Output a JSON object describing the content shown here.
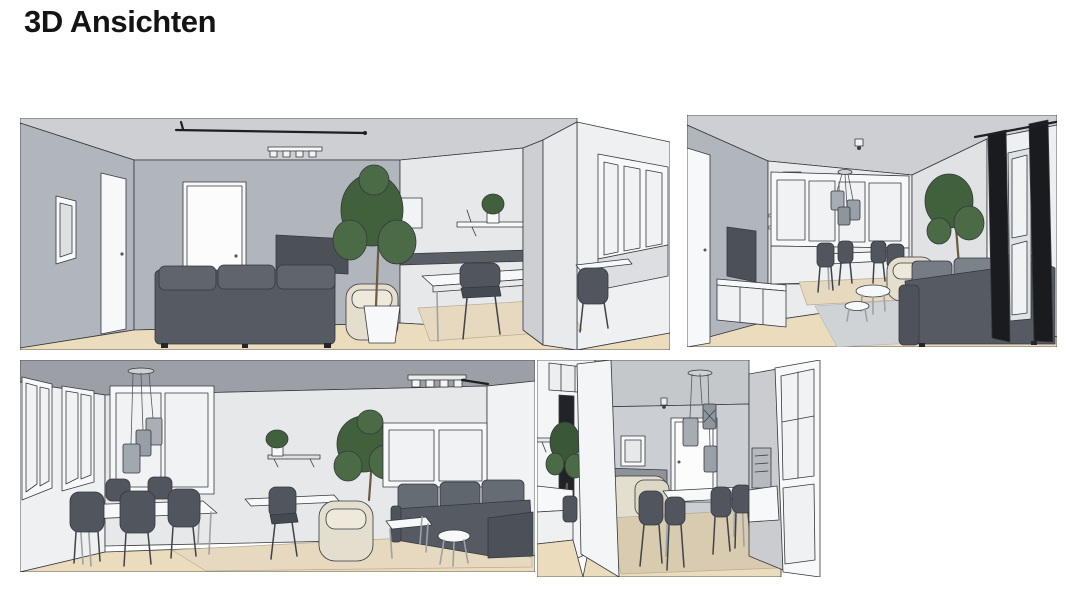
{
  "page": {
    "title": "3D Ansichten",
    "background": "#ffffff"
  },
  "views": [
    {
      "name": "wohnzimmer-ansicht-1",
      "description": "Wohnzimmer: graues Sofa, TV an der Wand, zwei weisse Tueren, Wandspiegel, Gardinenstange, Deckenstrahler, grosse Pflanze, Sessel, weisser Tisch mit dunklem Stuhl, Wandregal, Raumteiler und Fensterecke mit Stuhl"
    },
    {
      "name": "wohnzimmer-ansicht-2",
      "description": "Wohnzimmer: Tuer links, TV mit Sideboard, Fensterfront mit Esstisch und vier Stuehlen, Pendelleuchte, Deckenspot, Sessel, zwei runde Couchtische, graues Ecksofa, Pflanze und schwarze Vorhaenge am Fenster"
    },
    {
      "name": "essbereich-ansicht-1",
      "description": "Essbereich: Fensterwand links, Fenster hinten, drei Pendelleuchten, weisser Esstisch mit fuenf dunklen Stuehlen, Wandregal mit Pflanze, Schreibtischstuhl, Sessel, grosse Pflanze, Deckenstrahler, Ecksofa mit zwei Beistelltischen und Teppich"
    },
    {
      "name": "essbereich-ansicht-2",
      "description": "Blick durch Wandoeffnung auf Essplatz: weisse Tuer, Bilderrahmen, drei Pendelleuchten, weisser Esstisch mit vier dunklen Stuehlen, beiges Polstermoebel, Teppich, Glastuer rechts, Regal und Pflanze links"
    }
  ],
  "colors": {
    "wall_gray": "#b1b5bc",
    "wall_light": "#e6e8ea",
    "ceiling_light": "#cdcfd2",
    "ceiling_dark": "#9ca0a6",
    "floor_wood": "#ecdcbe",
    "sofa_dark": "#565b63",
    "chair_dark": "#51565e",
    "cushion_gray": "#757c84",
    "white_surface": "#f7f8f9",
    "glass_pane": "#f0f2f4",
    "plant_dark": "#41603c",
    "plant_light": "#4a6b45",
    "beige_fabric": "#e4decf",
    "rug_beige": "#e6d9c0",
    "rug_gray": "#cfd3d6",
    "tv_screen": "#4c5158",
    "curtain_black": "#1a1b1e",
    "sketch_line": "#35383d",
    "title_color": "#141414"
  }
}
